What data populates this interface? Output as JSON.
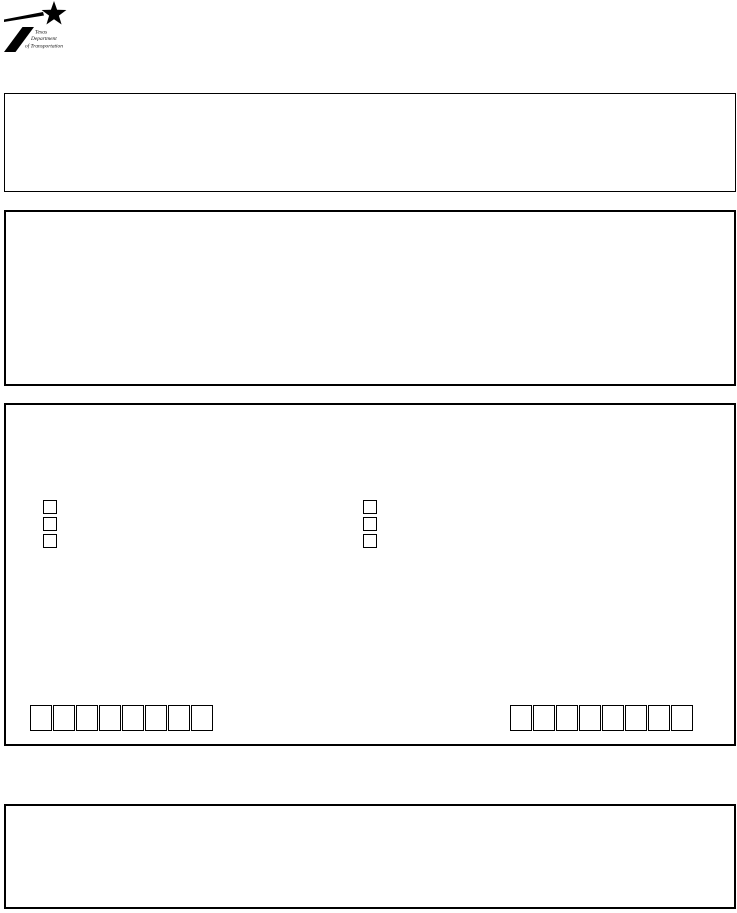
{
  "page": {
    "width": 737,
    "height": 913,
    "background": "#ffffff",
    "border_color": "#000000"
  },
  "logo": {
    "icon": "txdot-star-flag",
    "lines": [
      "Texas",
      "Department",
      "of Transportation"
    ]
  },
  "sections": [
    {
      "name": "header-box",
      "content": ""
    },
    {
      "name": "upper-box",
      "content": ""
    },
    {
      "name": "main-box",
      "content": ""
    },
    {
      "name": "footer-box",
      "content": ""
    }
  ],
  "checkbox_groups": [
    {
      "side": "left",
      "count": 3,
      "checked": [
        false,
        false,
        false
      ]
    },
    {
      "side": "right",
      "count": 3,
      "checked": [
        false,
        false,
        false
      ]
    }
  ],
  "charbox_groups": [
    {
      "side": "left",
      "cells": 8,
      "values": [
        "",
        "",
        "",
        "",
        "",
        "",
        "",
        ""
      ]
    },
    {
      "side": "right",
      "cells": 8,
      "values": [
        "",
        "",
        "",
        "",
        "",
        "",
        "",
        ""
      ]
    }
  ]
}
